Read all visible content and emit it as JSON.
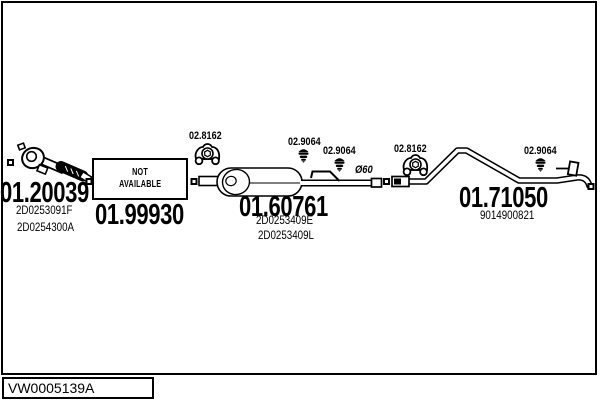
{
  "colors": {
    "line": "#000000",
    "background": "#ffffff"
  },
  "parts": [
    {
      "number": "01.20039",
      "refs": [
        "2D0253091F",
        "2D0254300A"
      ]
    },
    {
      "number": "01.99930",
      "note_lines": [
        "NOT",
        "AVAILABLE"
      ]
    },
    {
      "number": "01.60761",
      "refs": [
        "2D0253409E",
        "2D0253409L"
      ]
    },
    {
      "number": "01.71050",
      "refs": [
        "9014900821"
      ]
    }
  ],
  "mounts": [
    {
      "label": "02.8162",
      "icon": "rubber-mount-icon"
    },
    {
      "label": "02.9064",
      "icon": "rubber-hanger-icon"
    },
    {
      "label": "02.9064",
      "icon": "rubber-hanger-icon"
    },
    {
      "label": "02.8162",
      "icon": "rubber-mount-icon"
    },
    {
      "label": "02.9064",
      "icon": "rubber-hanger-icon"
    }
  ],
  "annotations": {
    "pipe_diameter": "Ø60"
  },
  "footer": {
    "drawing_code": "VW0005139A"
  }
}
